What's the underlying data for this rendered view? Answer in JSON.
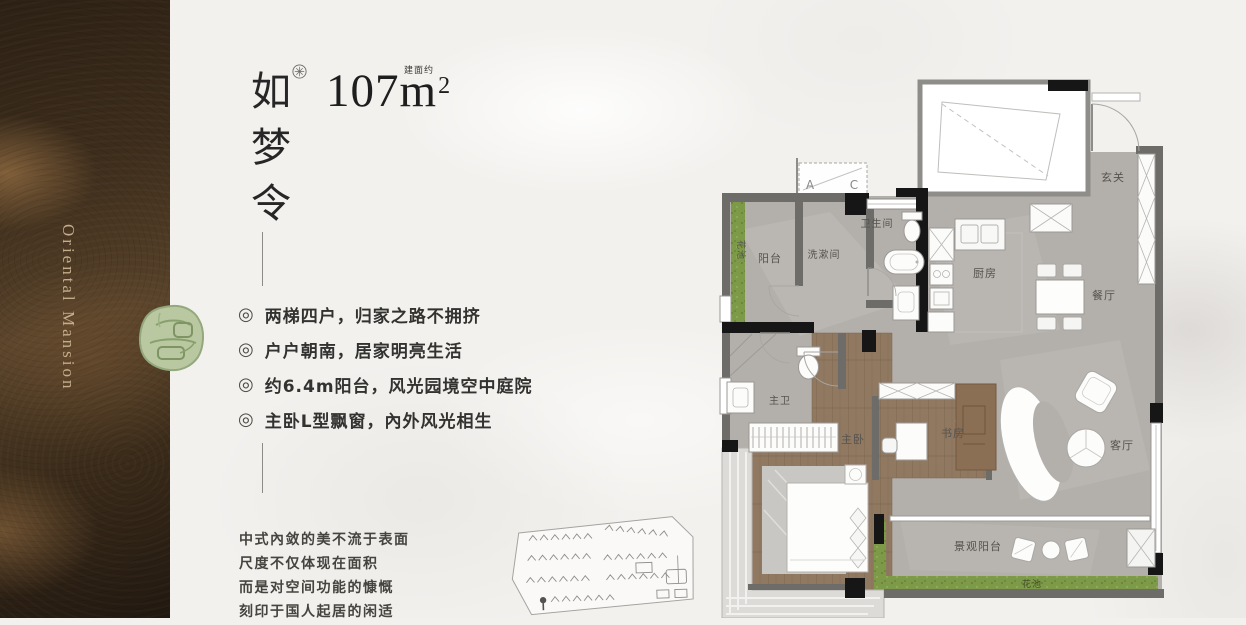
{
  "brand": {
    "vertical_text": "Oriental Mansion"
  },
  "listing": {
    "title_vertical": "如梦令",
    "area_number": "107m",
    "area_sup": "2",
    "area_prefix": "建面约",
    "bullet_glyph": "◎",
    "features": [
      "两梯四户，归家之路不拥挤",
      "户户朝南，居家明亮生活",
      "约6.4m阳台，风光园境空中庭院",
      "主卧L型飘窗，內外风光相生"
    ],
    "tagline_lines": [
      "中式內敛的美不流于表面",
      "尺度不仅体现在面积",
      "而是对空间功能的慷慨",
      "刻印于国人起居的闲适"
    ]
  },
  "floor_plan": {
    "ac_a": "A",
    "ac_c": "C",
    "rooms": {
      "balcony": "阳台",
      "washroom": "洗漱间",
      "bathroom": "卫生间",
      "kitchen": "厨房",
      "foyer": "玄关",
      "dining": "餐厅",
      "living": "客厅",
      "study": "书房",
      "master_bedroom": "主卧",
      "master_bath": "主卫",
      "view_balcony": "景观阳台",
      "flower_bed_left": "花池",
      "flower_bed_bottom": "花池"
    }
  },
  "colors": {
    "panel_brown": "#3c2c1b",
    "jade": "#b9c8a0",
    "floor_gray": "#b3afab",
    "floor_wood": "#8f7760",
    "grass": "#7d9a48",
    "wall_black": "#161616",
    "wall_gray": "#6e6c69"
  }
}
